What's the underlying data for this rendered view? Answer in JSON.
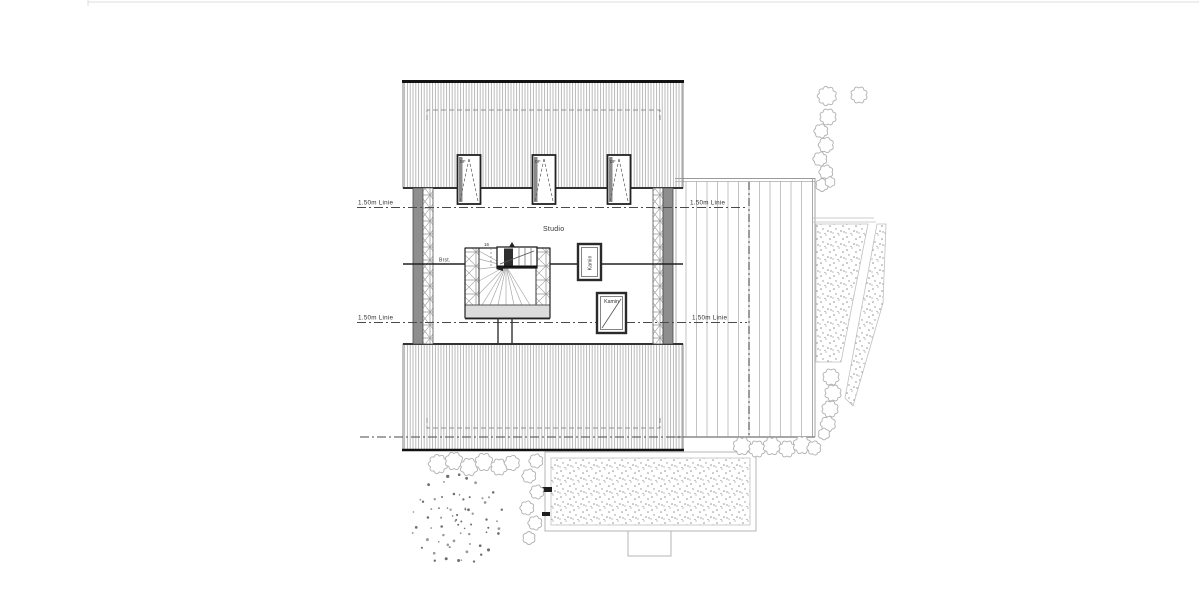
{
  "drawing": {
    "room_label": "Studio",
    "chimney_label": "Kamin",
    "parapet_label": "Brst.",
    "roof_window_label": "DF",
    "stair_steps_label": "16",
    "height_line_label": "1.50m Linie"
  },
  "colors": {
    "wall_fill": "#8e8e8e",
    "roof_hatch": "#b2b2b2",
    "outline_dark": "#1c1c1c",
    "dash_line": "#4a4a4a",
    "stipple_dot": "#909090",
    "bush_outline": "#b0b0b0",
    "planting_dot": "#6e6e6e",
    "label_text": "#333333",
    "landing_fill": "#dcdcdc",
    "deck_plank": "#bdbdbd"
  }
}
